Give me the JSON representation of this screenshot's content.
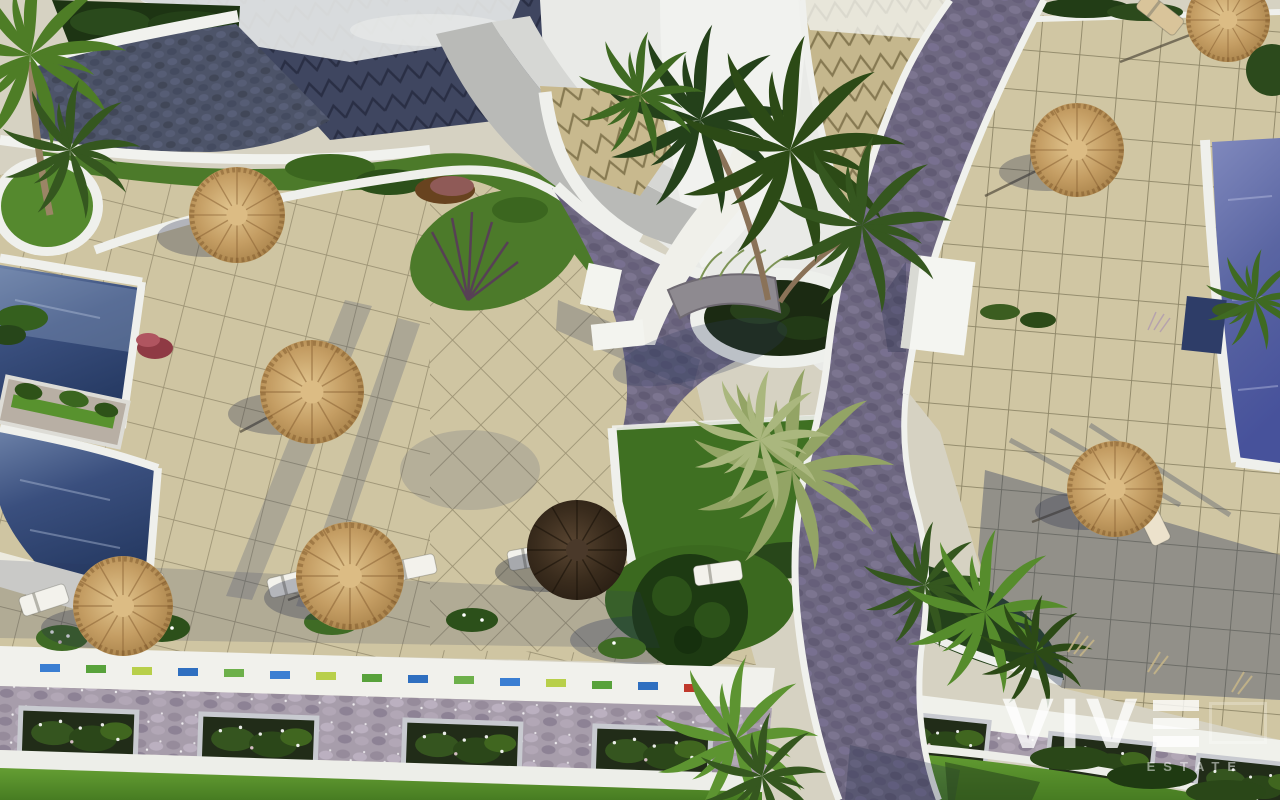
{
  "watermark": {
    "brand": "VIVE",
    "brand_prefix": "VIV",
    "stylized_e": "three-horizontal-bars",
    "tagline": "ESTATE",
    "color": "#ffffff"
  },
  "scene": {
    "type": "aerial-3d-architectural-render",
    "subject": "resort community pool terraces with thatch parasols, palm trees, cobblestone walkways and planters",
    "counts": {
      "swimming_pools": 3,
      "thatch_parasols": 7,
      "dark_parasols": 1,
      "sun_loungers": 9,
      "wall_planter_boxes": 7,
      "palm_trees": 12,
      "circular_planters": 2
    },
    "palette": {
      "terrace_tile": "#cfc5a2",
      "tile_grout": "#8b8164",
      "pool_deep": "#263a63",
      "pool_violet": "#5a65a2",
      "cobblestone": "#6e6881",
      "white_walls": "#f0f1ec",
      "lawn": "#55862c",
      "garden_dark": "#24411a",
      "thatch": "#c49d63",
      "roof_navy": "#3f4660",
      "roof_tan": "#c8b98e",
      "stone_wall": "#a79dab"
    }
  }
}
